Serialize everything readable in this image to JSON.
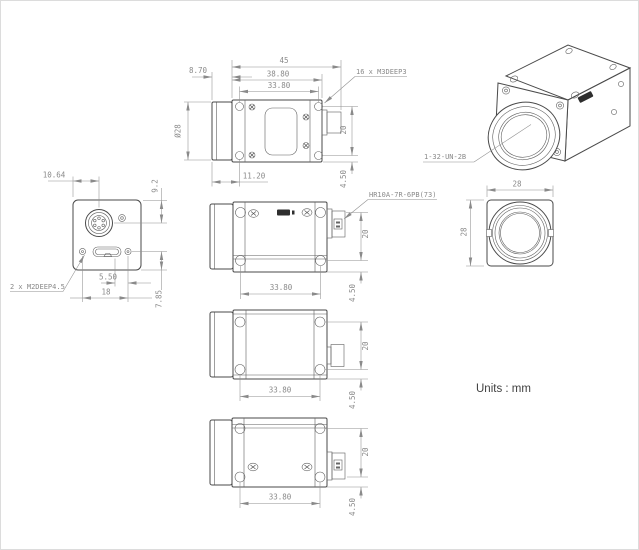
{
  "units_note": "Units : mm",
  "top_view": {
    "dim_total_length": "45",
    "dim_lens_protrusion": "8.70",
    "dim_body_length": "38.80",
    "dim_mount_hole_span": "33.80",
    "dim_lens_diameter": "Ø28",
    "dim_lens_to_hole": "11.20",
    "dim_hole_span_vertical": "20",
    "dim_hole_to_edge": "4.50",
    "note_mount_holes": "16 x M3DEEP3"
  },
  "back_view": {
    "dim_connector_offset_x": "10.64",
    "dim_connector_offset_y": "9.2",
    "dim_usb_to_screw": "5.50",
    "dim_screw_span": "18",
    "dim_usb_to_bottom": "7.85",
    "note_screw_holes": "2 x M2DEEP4.5"
  },
  "perspective_view": {
    "note_lens_thread": "1-32-UN-2B"
  },
  "front_view": {
    "dim_width": "28",
    "dim_height": "28"
  },
  "side_view_right": {
    "dim_mount_hole_span": "33.80",
    "dim_hole_span_vertical": "20",
    "dim_hole_to_edge": "4.50",
    "note_connector": "HR10A-7R-6PB(73)"
  },
  "side_view_bottom": {
    "dim_mount_hole_span": "33.80",
    "dim_hole_span_vertical": "20",
    "dim_hole_to_edge": "4.50"
  },
  "side_view_left": {
    "dim_mount_hole_span": "33.80",
    "dim_hole_span_vertical": "20",
    "dim_hole_to_edge": "4.50"
  }
}
